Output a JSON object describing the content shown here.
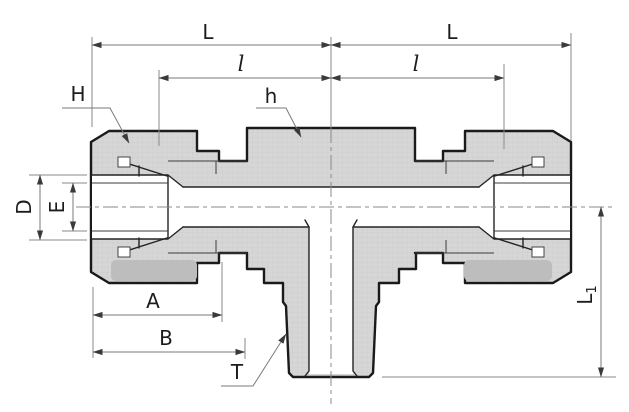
{
  "labels": {
    "L_left": "L",
    "L_right": "L",
    "l_left": "l",
    "l_right": "l",
    "H": "H",
    "h": "h",
    "D": "D",
    "E": "E",
    "A": "A",
    "B": "B",
    "T": "T",
    "L1_main": "L",
    "L1_sub": "1"
  },
  "colors": {
    "body_fill": "#d6d6d6",
    "hatch_line": "#c7c7c7",
    "nut_shadow_band": "#bdbdbd",
    "outline": "#1a1a1a",
    "dimension_line": "#7a7a7a",
    "arrow": "#3a3a3a",
    "label_text": "#1c1c1c",
    "bore_white": "#ffffff",
    "background": "#ffffff"
  }
}
